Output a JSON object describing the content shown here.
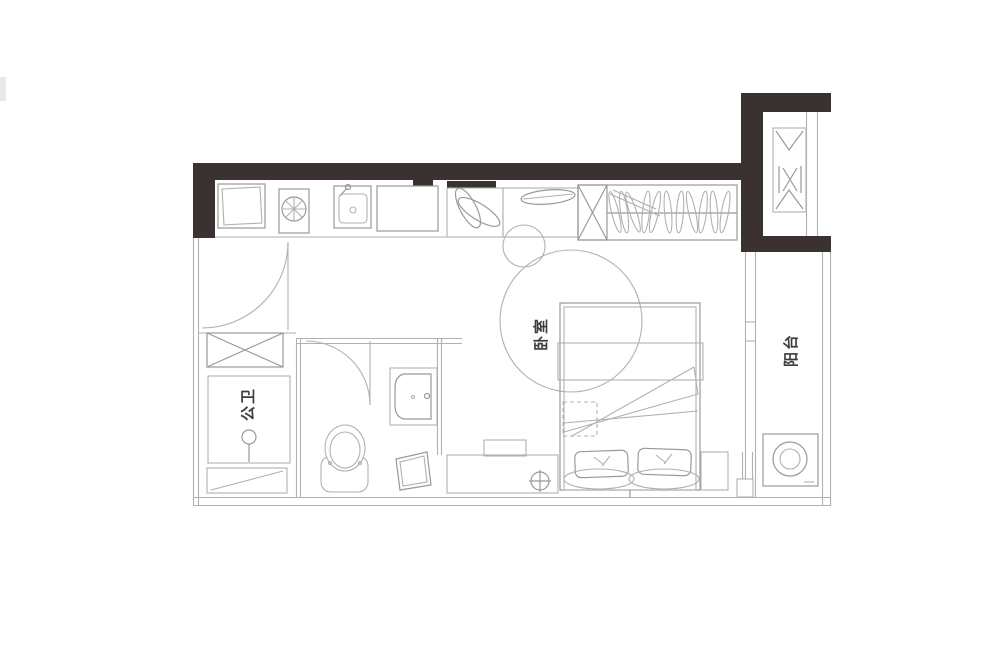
{
  "title": "studio-apartment-floor-plan",
  "rooms": {
    "bathroom": {
      "label": "公卫"
    },
    "bedroom": {
      "label": "卧室"
    },
    "balcony": {
      "label": "阳台"
    }
  },
  "colors": {
    "bg": "#ffffff",
    "wall": "#3a3231",
    "line": "#b2b1b0",
    "line_dark": "#9a9998",
    "label": "#3f3e3e"
  },
  "fixtures": [
    "entry-door",
    "kitchen-cabinet",
    "cooktop",
    "kitchen-sink",
    "fridge",
    "plant",
    "side-cabinet",
    "wardrobe",
    "duct-shaft",
    "shoe-cabinet",
    "shower",
    "shower-head",
    "bench",
    "toilet",
    "vanity-sink",
    "stool",
    "desk",
    "floor-drain",
    "bed",
    "pillow",
    "nightstand",
    "sliding-door",
    "washing-machine"
  ]
}
